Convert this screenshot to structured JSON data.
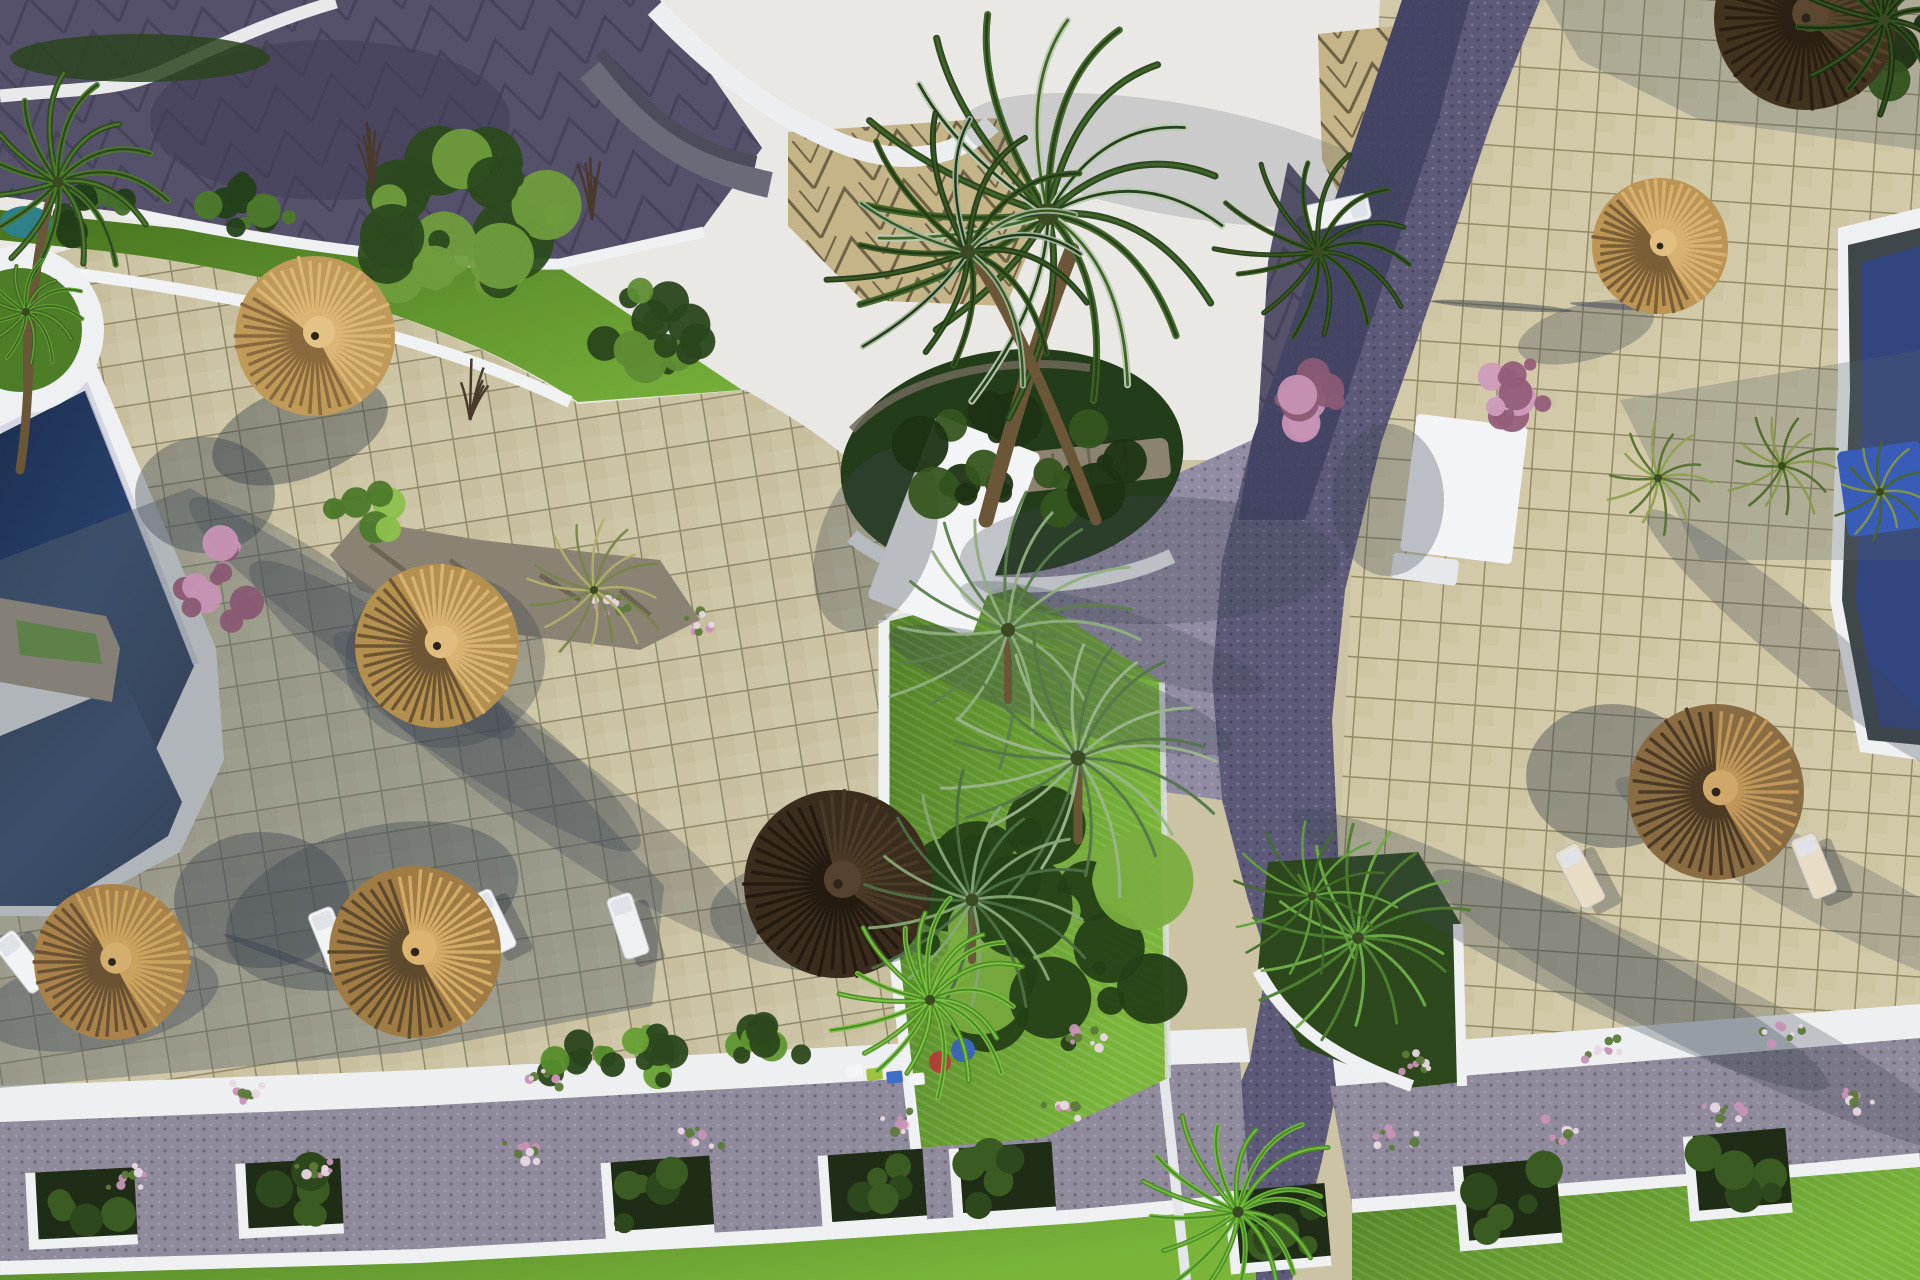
{
  "image": {
    "kind": "aerial-3d-architectural-render",
    "subject": "resort pool deck and plaza with thatch umbrellas, palms, cobble paths and planters",
    "width": 1920,
    "height": 1280
  },
  "colors": {
    "tile_left": "#cbc3a3",
    "tile_right": "#d2c9a8",
    "grout": "#8f8869",
    "tile_shadow": "#5a646b",
    "roof_white": "#e9e8e4",
    "roof_dark": "#55516a",
    "tier_gray": "#6a6a78",
    "tan_chevron": "#c4b488",
    "chevron_line": "#6e6244",
    "road_dark": "#3f4260",
    "road_mid": "#5c5a78",
    "road_light": "#928ba4",
    "gravel": "#8f8a9c",
    "white_struct": "#f3f4f6",
    "walk_white": "#edeff1",
    "curb_white": "#eef0f2",
    "pool_navy": "#24395e",
    "pool_deep": "#16284a",
    "pool_right": "#33457e",
    "pool_teal": "#2e8089",
    "slate": "#3f474b",
    "blue_mat": "#2b59d6",
    "deck_white": "#eef0f1",
    "lawn_bright": "#6fae35",
    "lawn_mid": "#4e7d28",
    "lawn_dark": "#2f4d1c",
    "bush_dark": "#27401a",
    "bush_light": "#7fb344",
    "stone": "#97907c",
    "bench_stone": "#8b8370",
    "planter_soil": "#1f2d16",
    "straw_light": "#d9b274",
    "straw_mid": "#c09a58",
    "straw_dark": "#7c5f38",
    "thatch_dark": "#42331f",
    "thatch_mid": "#5a4630",
    "trunk": "#6b5638",
    "pink": "#c792b4"
  },
  "scene": {
    "umbrellas": [
      {
        "kind": "straw-umbrella",
        "cx": 315,
        "cy": 336,
        "r": 80,
        "light": "#dcb574",
        "mid": "#c09a58",
        "dark": "#8a6a3c",
        "cap": "#e4c286",
        "lit": -0.7,
        "cut": -0.2
      },
      {
        "kind": "straw-umbrella",
        "cx": 437,
        "cy": 646,
        "r": 82,
        "light": "#d9b272",
        "mid": "#b4904e",
        "dark": "#6e5634",
        "cap": "#e0bd7e",
        "lit": -0.5,
        "cut": 0.0
      },
      {
        "kind": "straw-umbrella",
        "cx": 415,
        "cy": 952,
        "r": 86,
        "light": "#d4ab66",
        "mid": "#a07c44",
        "dark": "#5e4a2c",
        "cap": "#dcb470",
        "lit": -0.4,
        "cut": 0.1
      },
      {
        "kind": "straw-umbrella",
        "cx": 112,
        "cy": 962,
        "r": 78,
        "light": "#caa35e",
        "mid": "#a8824a",
        "dark": "#6a5232",
        "cap": "#d4ae6c",
        "lit": -0.5,
        "cut": 0.0
      },
      {
        "kind": "thatch-umbrella-dark",
        "cx": 838,
        "cy": 884,
        "r": 94,
        "light": "#4a3a26",
        "mid": "#3a2d1e",
        "dark": "#241a10",
        "cap": "#554330",
        "lit": -0.6,
        "cut": 0.3
      },
      {
        "kind": "straw-umbrella",
        "cx": 1660,
        "cy": 246,
        "r": 68,
        "light": "#d8b070",
        "mid": "#bc9454",
        "dark": "#7a5e36",
        "cap": "#e2bf80",
        "lit": -0.6,
        "cut": -0.1
      },
      {
        "kind": "thatch-umbrella",
        "cx": 1716,
        "cy": 792,
        "r": 88,
        "light": "#c09659",
        "mid": "#8a6c42",
        "dark": "#4c3a24",
        "cap": "#cfa768",
        "lit": -0.3,
        "cut": 0.25
      },
      {
        "kind": "thatch-umbrella-dark",
        "cx": 1806,
        "cy": 18,
        "r": 92,
        "light": "#55432c",
        "mid": "#42331f",
        "dark": "#2a1f12",
        "cap": "#5c4830",
        "lit": -0.5,
        "cut": 0.3
      }
    ],
    "palms": [
      {
        "kind": "fan",
        "cx": 1048,
        "cy": 214,
        "r": 222,
        "n": 20,
        "c1": "#27431c",
        "c2": "#3f6527",
        "hi": "#b9c9b2",
        "w": 7,
        "trunk": "M986,520 C1010,430 1040,330 1072,250",
        "tw": 15
      },
      {
        "kind": "fan",
        "cx": 968,
        "cy": 252,
        "r": 150,
        "n": 16,
        "c1": "#22391a",
        "c2": "#38591f",
        "hi": "#9fb49a",
        "w": 6,
        "trunk": "M1096,520 C1062,430 1020,330 980,266",
        "tw": 11
      },
      {
        "kind": "fan",
        "cx": 58,
        "cy": 182,
        "r": 110,
        "n": 15,
        "c1": "#2c4a1e",
        "c2": "#4c7a2a",
        "w": 6,
        "trunk": "M20,470 C34,380 24,300 50,200",
        "tw": 9
      },
      {
        "kind": "fan",
        "cx": 26,
        "cy": 312,
        "r": 58,
        "n": 13,
        "c1": "#3c6322",
        "c2": "#63a033",
        "w": 4,
        "trunk": "M26,382 L26,318",
        "tw": 6
      },
      {
        "kind": "date",
        "cx": 1008,
        "cy": 630,
        "r": 140,
        "n": 20,
        "c1": "#5c7f4e",
        "c2": "#8fae7e",
        "w": 3,
        "trunk": "M1008,700 L1008,636",
        "tw": 8
      },
      {
        "kind": "date",
        "cx": 1078,
        "cy": 758,
        "r": 152,
        "n": 22,
        "c1": "#54774a",
        "c2": "#9ab58a",
        "w": 3,
        "trunk": "M1078,840 L1078,764",
        "tw": 9
      },
      {
        "kind": "date",
        "cx": 972,
        "cy": 900,
        "r": 128,
        "n": 18,
        "c1": "#4c6f44",
        "c2": "#86a576",
        "w": 3,
        "trunk": "M972,960 L972,906",
        "tw": 8
      },
      {
        "kind": "date",
        "cx": 594,
        "cy": 590,
        "r": 74,
        "n": 16,
        "c1": "#77854a",
        "c2": "#b0b06a",
        "w": 2.5
      },
      {
        "kind": "fan",
        "cx": 930,
        "cy": 1000,
        "r": 104,
        "n": 18,
        "c1": "#4c8a24",
        "c2": "#7cc244",
        "w": 5
      },
      {
        "kind": "fan",
        "cx": 1238,
        "cy": 1212,
        "r": 112,
        "n": 17,
        "c1": "#4c8a24",
        "c2": "#74bc3e",
        "w": 5
      },
      {
        "kind": "date",
        "cx": 1358,
        "cy": 938,
        "r": 118,
        "n": 18,
        "c1": "#4e8030",
        "c2": "#6fae49",
        "w": 3
      },
      {
        "kind": "date",
        "cx": 1312,
        "cy": 896,
        "r": 86,
        "n": 14,
        "c1": "#446e2a",
        "c2": "#64a03e",
        "w": 2.5
      },
      {
        "kind": "date",
        "cx": 1658,
        "cy": 478,
        "r": 56,
        "n": 14,
        "c1": "#55722e",
        "c2": "#91a04e",
        "w": 2.5
      },
      {
        "kind": "date",
        "cx": 1782,
        "cy": 466,
        "r": 58,
        "n": 14,
        "c1": "#4e6a2a",
        "c2": "#889a48",
        "w": 2.5
      },
      {
        "kind": "date",
        "cx": 1880,
        "cy": 492,
        "r": 52,
        "n": 12,
        "c1": "#4a662a",
        "c2": "#829644",
        "w": 2.5
      },
      {
        "kind": "fan",
        "cx": 1318,
        "cy": 252,
        "r": 108,
        "n": 14,
        "c1": "#223c16",
        "c2": "#39581f",
        "w": 5
      },
      {
        "kind": "fan",
        "cx": 1884,
        "cy": 20,
        "r": 108,
        "n": 13,
        "c1": "#1c3012",
        "c2": "#33511f",
        "w": 6
      }
    ],
    "loungers": [
      {
        "cx": 22,
        "cy": 962,
        "rot": -38,
        "c": "#f2f3f4"
      },
      {
        "cx": 331,
        "cy": 940,
        "rot": -22,
        "c": "#f2f3f4"
      },
      {
        "cx": 492,
        "cy": 922,
        "rot": -26,
        "c": "#f2f3f4"
      },
      {
        "cx": 628,
        "cy": 926,
        "rot": -18,
        "c": "#eef0f2"
      },
      {
        "cx": 1580,
        "cy": 876,
        "rot": -28,
        "c": "#e8ddc4"
      },
      {
        "cx": 1814,
        "cy": 866,
        "rot": -22,
        "c": "#e8ddc4"
      },
      {
        "cx": 1770,
        "cy": 58,
        "rot": -30,
        "c": "#e6dcc6"
      },
      {
        "cx": 1338,
        "cy": 212,
        "rot": 78,
        "c": "#f0f1f3"
      }
    ],
    "planter_boxes": [
      {
        "cx": 84,
        "cy": 1206,
        "w": 104,
        "h": 72,
        "rot": -3
      },
      {
        "cx": 292,
        "cy": 1196,
        "w": 100,
        "h": 70,
        "rot": -3
      },
      {
        "cx": 660,
        "cy": 1196,
        "w": 104,
        "h": 74,
        "rot": -4
      },
      {
        "cx": 875,
        "cy": 1188,
        "w": 100,
        "h": 72,
        "rot": -4
      },
      {
        "cx": 1005,
        "cy": 1180,
        "w": 98,
        "h": 70,
        "rot": -4
      },
      {
        "cx": 1280,
        "cy": 1226,
        "w": 96,
        "h": 78,
        "rot": -5
      },
      {
        "cx": 1510,
        "cy": 1202,
        "w": 98,
        "h": 80,
        "rot": -5
      },
      {
        "cx": 1740,
        "cy": 1172,
        "w": 98,
        "h": 80,
        "rot": -5
      }
    ],
    "mini_boxes": [
      {
        "x": 846,
        "y": 1066,
        "c": "#f4f5f6"
      },
      {
        "x": 866,
        "y": 1069,
        "c": "#9ec43e"
      },
      {
        "x": 886,
        "y": 1072,
        "c": "#3e6fc4"
      },
      {
        "x": 908,
        "y": 1074,
        "c": "#f4f5f6"
      }
    ],
    "pots": [
      {
        "cx": 940,
        "cy": 1062,
        "r": 11,
        "c": "#b04038"
      },
      {
        "cx": 963,
        "cy": 1050,
        "r": 12,
        "c": "#3a66b8"
      }
    ],
    "bushes": [
      {
        "cx": 475,
        "cy": 235,
        "rx": 96,
        "ry": 86,
        "n": 26,
        "c1": "#2c4a1e",
        "c2": "#6f9c3c"
      },
      {
        "cx": 645,
        "cy": 330,
        "rx": 55,
        "ry": 42,
        "n": 14,
        "c1": "#2a461c",
        "c2": "#5f8c34"
      },
      {
        "cx": 250,
        "cy": 208,
        "rx": 42,
        "ry": 30,
        "n": 10,
        "c1": "#24401a",
        "c2": "#4c7a2a"
      },
      {
        "cx": 95,
        "cy": 212,
        "rx": 40,
        "ry": 26,
        "n": 9,
        "c1": "#223c18",
        "c2": "#44702a"
      },
      {
        "cx": 1010,
        "cy": 468,
        "rx": 118,
        "ry": 58,
        "n": 20,
        "c1": "#1d3314",
        "c2": "#35551f"
      },
      {
        "cx": 1040,
        "cy": 940,
        "rx": 128,
        "ry": 118,
        "n": 30,
        "c1": "#244016",
        "c2": "#79ad3f"
      },
      {
        "cx": 660,
        "cy": 1054,
        "rx": 52,
        "ry": 26,
        "n": 10,
        "c1": "#2c481c",
        "c2": "#67a035"
      },
      {
        "cx": 762,
        "cy": 1044,
        "rx": 46,
        "ry": 24,
        "n": 9,
        "c1": "#2c481c",
        "c2": "#5f9630"
      },
      {
        "cx": 582,
        "cy": 1064,
        "rx": 40,
        "ry": 22,
        "n": 8,
        "c1": "#2a441c",
        "c2": "#568c2c"
      },
      {
        "cx": 1850,
        "cy": 30,
        "rx": 118,
        "ry": 66,
        "n": 18,
        "c1": "#1c2e12",
        "c2": "#33511f"
      },
      {
        "cx": 222,
        "cy": 582,
        "rx": 48,
        "ry": 40,
        "n": 12,
        "c1": "#8a5a74",
        "c2": "#c792b4"
      },
      {
        "cx": 1308,
        "cy": 396,
        "rx": 42,
        "ry": 34,
        "n": 10,
        "c1": "#8a5a74",
        "c2": "#c792b4"
      },
      {
        "cx": 1502,
        "cy": 392,
        "rx": 46,
        "ry": 36,
        "n": 11,
        "c1": "#935e7a",
        "c2": "#cf9cba"
      },
      {
        "cx": 368,
        "cy": 518,
        "rx": 40,
        "ry": 26,
        "n": 8,
        "c1": "#4c7a2a",
        "c2": "#8cc04c"
      }
    ],
    "flower_tufts": [
      {
        "cx": 130,
        "cy": 1180
      },
      {
        "cx": 320,
        "cy": 1168
      },
      {
        "cx": 520,
        "cy": 1152
      },
      {
        "cx": 700,
        "cy": 1140
      },
      {
        "cx": 900,
        "cy": 1122
      },
      {
        "cx": 1060,
        "cy": 1110
      },
      {
        "cx": 1400,
        "cy": 1140
      },
      {
        "cx": 1560,
        "cy": 1128
      },
      {
        "cx": 1720,
        "cy": 1112
      },
      {
        "cx": 1860,
        "cy": 1098
      },
      {
        "cx": 250,
        "cy": 1092
      },
      {
        "cx": 540,
        "cy": 1078
      },
      {
        "cx": 1080,
        "cy": 1040
      },
      {
        "cx": 1420,
        "cy": 1062
      },
      {
        "cx": 1600,
        "cy": 1048
      },
      {
        "cx": 1780,
        "cy": 1032
      },
      {
        "cx": 610,
        "cy": 602
      },
      {
        "cx": 692,
        "cy": 622
      }
    ],
    "twig_trees": [
      {
        "cx": 372,
        "cy": 190,
        "h": 80
      },
      {
        "cx": 592,
        "cy": 220,
        "h": 70
      },
      {
        "cx": 470,
        "cy": 420,
        "h": 64
      }
    ],
    "shadows": [
      {
        "cx": 300,
        "cy": 432,
        "rx": 92,
        "ry": 46,
        "rot": -20,
        "op": 0.45
      },
      {
        "cx": 205,
        "cy": 495,
        "rx": 70,
        "ry": 58,
        "rot": 0,
        "op": 0.4
      },
      {
        "cx": 445,
        "cy": 660,
        "rx": 100,
        "ry": 88,
        "rot": 0,
        "op": 0.32
      },
      {
        "cx": 352,
        "cy": 618,
        "rx": 200,
        "ry": 36,
        "rot": 36,
        "op": 0.3
      },
      {
        "cx": 445,
        "cy": 706,
        "rx": 240,
        "ry": 44,
        "rot": 36,
        "op": 0.3
      },
      {
        "cx": 545,
        "cy": 788,
        "rx": 260,
        "ry": 44,
        "rot": 36,
        "op": 0.28
      },
      {
        "cx": 372,
        "cy": 906,
        "rx": 150,
        "ry": 78,
        "rot": -15,
        "op": 0.38
      },
      {
        "cx": 262,
        "cy": 900,
        "rx": 88,
        "ry": 68,
        "rot": 0,
        "op": 0.42
      },
      {
        "cx": 100,
        "cy": 1000,
        "rx": 120,
        "ry": 48,
        "rot": -10,
        "op": 0.35
      },
      {
        "cx": 828,
        "cy": 914,
        "rx": 118,
        "ry": 58,
        "rot": 0,
        "op": 0.35
      },
      {
        "cx": 1060,
        "cy": 690,
        "rx": 180,
        "ry": 36,
        "rot": 18,
        "op": 0.3
      },
      {
        "cx": 1112,
        "cy": 638,
        "rx": 160,
        "ry": 30,
        "rot": 18,
        "op": 0.26
      },
      {
        "cx": 1612,
        "cy": 776,
        "rx": 86,
        "ry": 72,
        "rot": 0,
        "op": 0.42
      },
      {
        "cx": 1586,
        "cy": 332,
        "rx": 70,
        "ry": 28,
        "rot": -15,
        "op": 0.32
      },
      {
        "cx": 1560,
        "cy": 950,
        "rx": 300,
        "ry": 40,
        "rot": 27,
        "op": 0.3
      },
      {
        "cx": 1700,
        "cy": 1010,
        "rx": 300,
        "ry": 40,
        "rot": 27,
        "op": 0.26
      },
      {
        "cx": 1830,
        "cy": 890,
        "rx": 240,
        "ry": 36,
        "rot": 27,
        "op": 0.24
      },
      {
        "cx": 1800,
        "cy": 640,
        "rx": 200,
        "ry": 30,
        "rot": 40,
        "op": 0.28
      },
      {
        "cx": 1502,
        "cy": 306,
        "rx": 70,
        "ry": 4,
        "rot": 4,
        "op": 0.5
      },
      {
        "cx": 1610,
        "cy": 306,
        "rx": 40,
        "ry": 3,
        "rot": 4,
        "op": 0.5
      },
      {
        "cx": 280,
        "cy": 955,
        "rx": 60,
        "ry": 4,
        "rot": 20,
        "op": 0.5
      },
      {
        "cx": 1388,
        "cy": 500,
        "rx": 56,
        "ry": 76,
        "rot": 0,
        "op": 0.3
      },
      {
        "cx": 876,
        "cy": 540,
        "rx": 56,
        "ry": 96,
        "rot": 21,
        "op": 0.32
      },
      {
        "cx": 1150,
        "cy": 560,
        "rx": 190,
        "ry": 64,
        "rot": 0,
        "op": 0.28
      },
      {
        "cx": 1180,
        "cy": 160,
        "rx": 220,
        "ry": 56,
        "rot": 10,
        "op": 0.18
      }
    ]
  }
}
